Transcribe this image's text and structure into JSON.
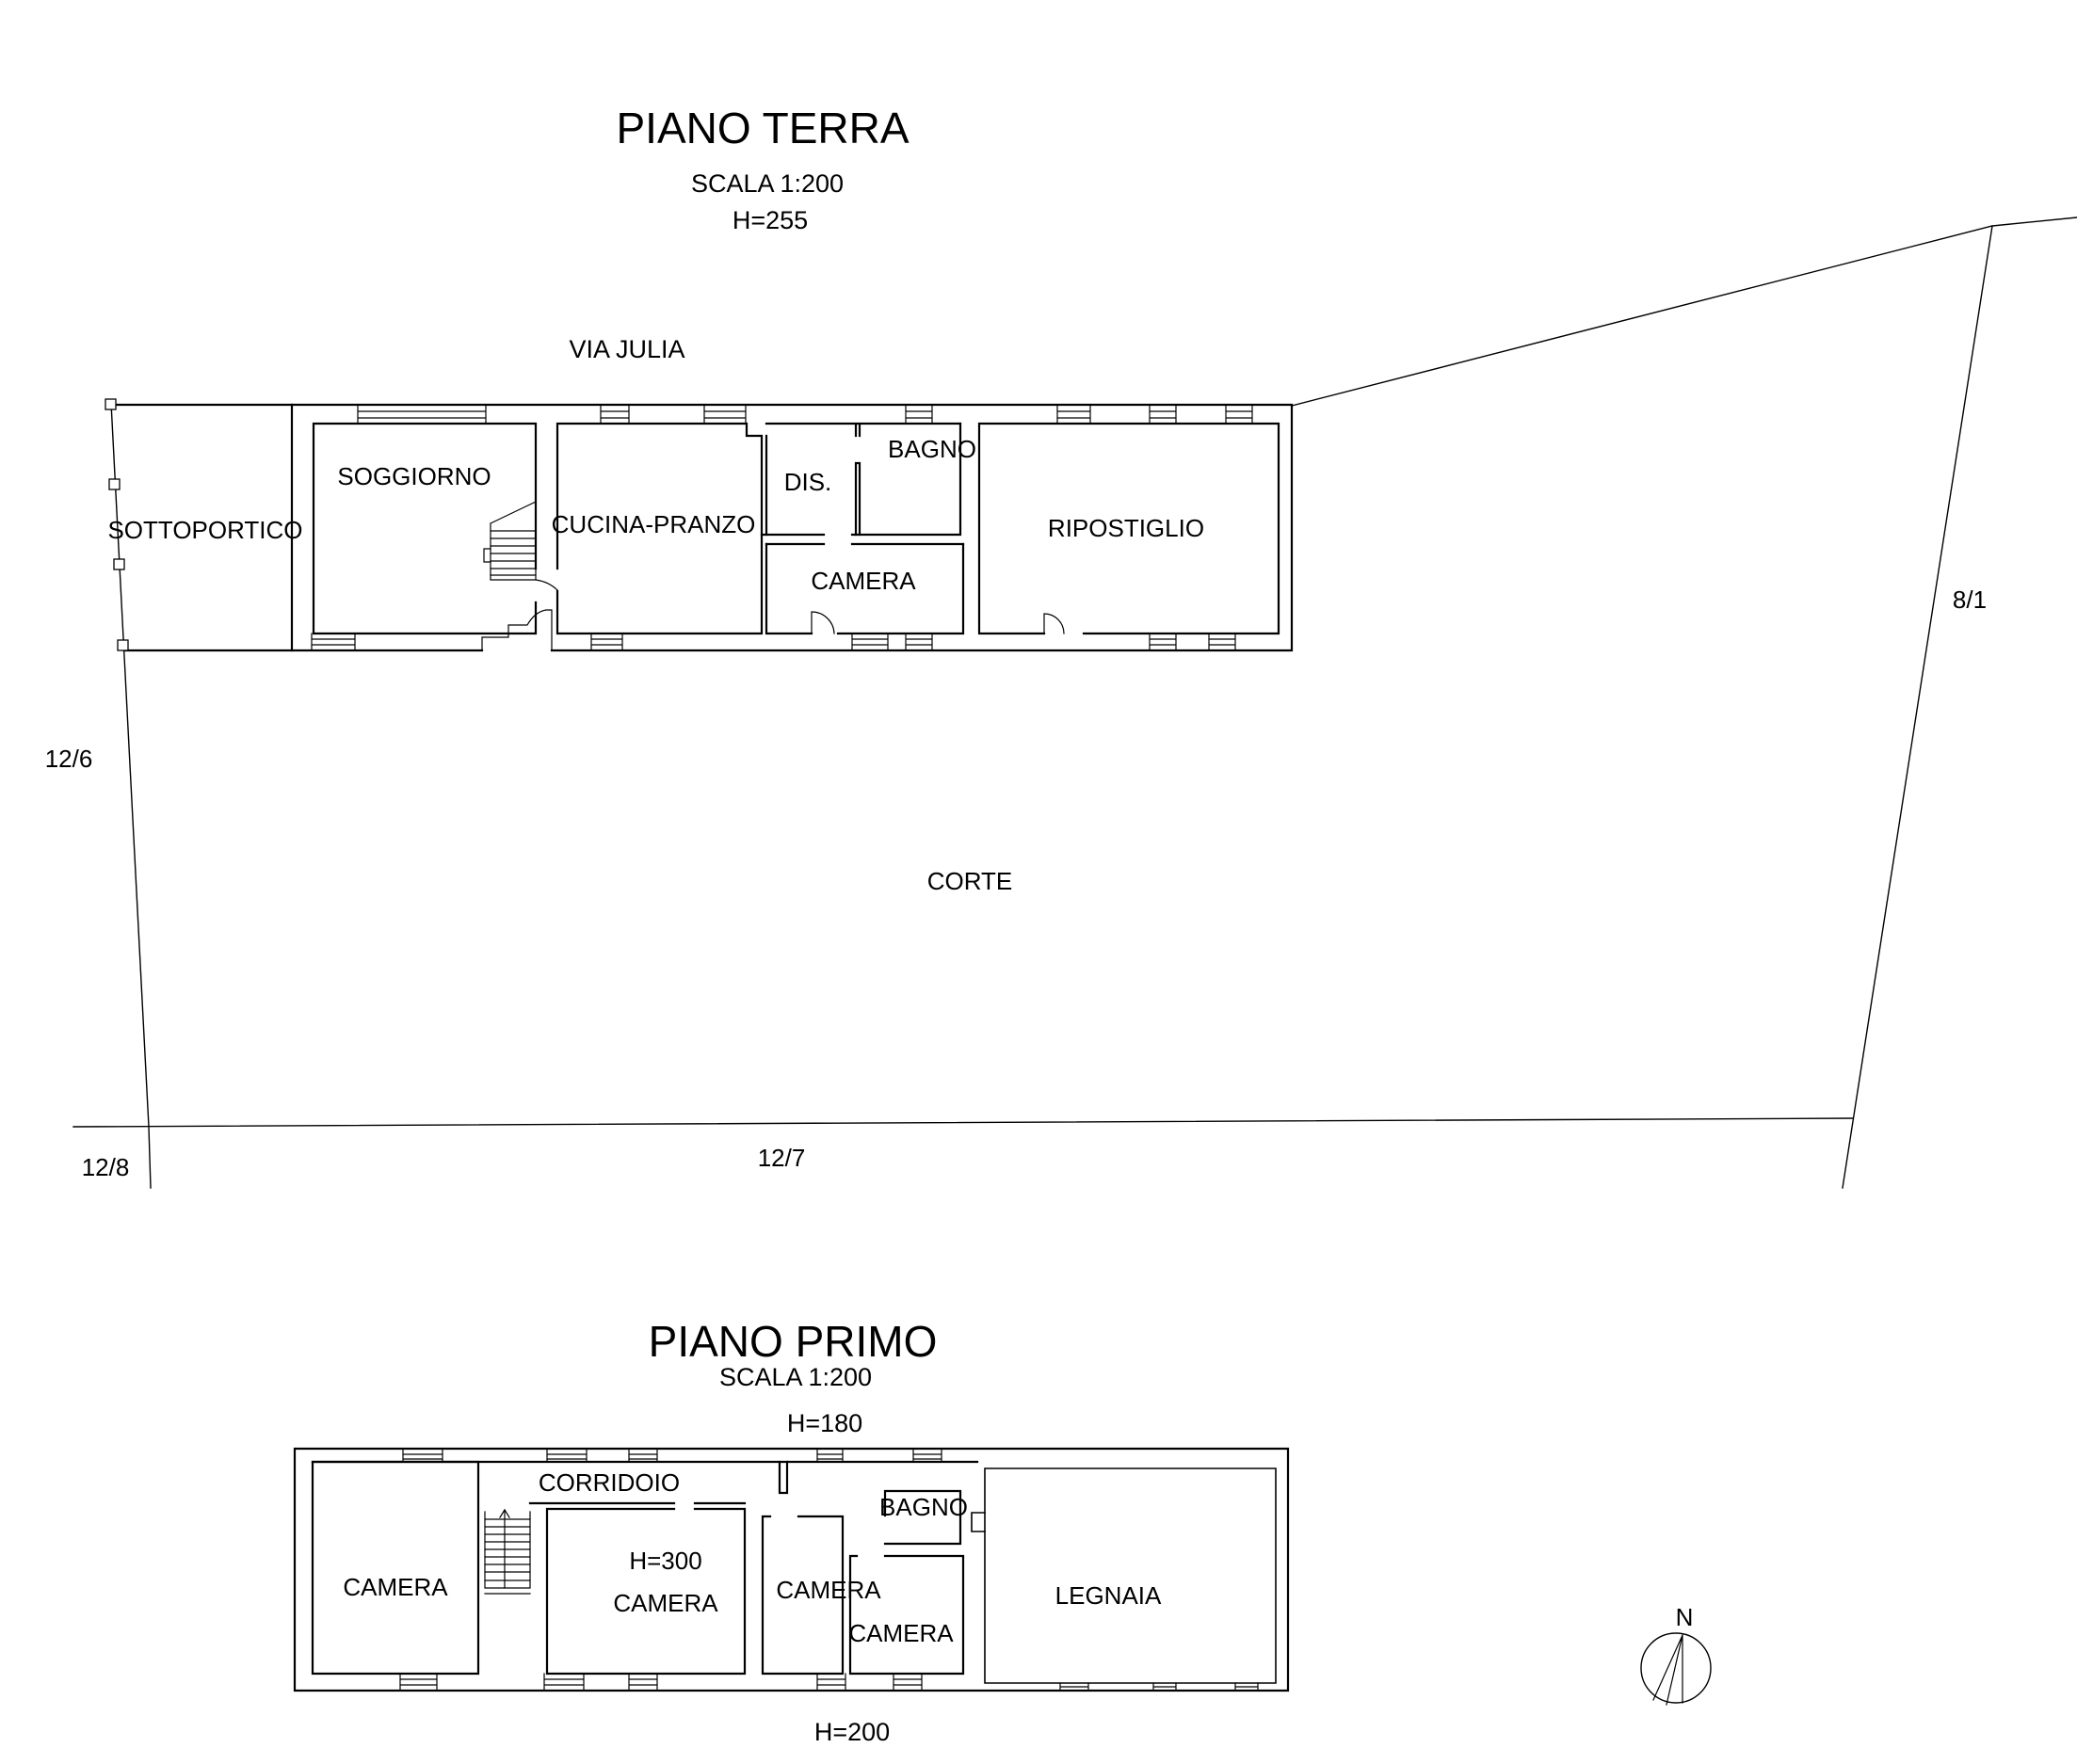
{
  "ground_floor": {
    "title": "PIANO TERRA",
    "scale_label": "SCALA 1:200",
    "height_label": "H=255",
    "street_label": "VIA JULIA",
    "court_label": "CORTE",
    "parcels": {
      "west": "12/6",
      "southwest": "12/8",
      "south": "12/7",
      "east": "8/1"
    },
    "rooms": {
      "sottoportico": "SOTTOPORTICO",
      "soggiorno": "SOGGIORNO",
      "cucina_pranzo": "CUCINA-PRANZO",
      "disimpegno": "DIS.",
      "bagno": "BAGNO",
      "camera": "CAMERA",
      "ripostiglio": "RIPOSTIGLIO"
    }
  },
  "first_floor": {
    "title": "PIANO PRIMO",
    "scale_label": "SCALA 1:200",
    "height_top_label": "H=180",
    "height_bottom_label": "H=200",
    "rooms": {
      "camera_ovest": "CAMERA",
      "corridoio": "CORRIDOIO",
      "camera_centrale_height": "H=300",
      "camera_centrale": "CAMERA",
      "camera_media": "CAMERA",
      "camera_est": "CAMERA",
      "bagno": "BAGNO",
      "legnaia": "LEGNAIA"
    }
  },
  "compass": {
    "north_label": "N"
  },
  "colors": {
    "line": "#000000",
    "background": "#ffffff"
  }
}
